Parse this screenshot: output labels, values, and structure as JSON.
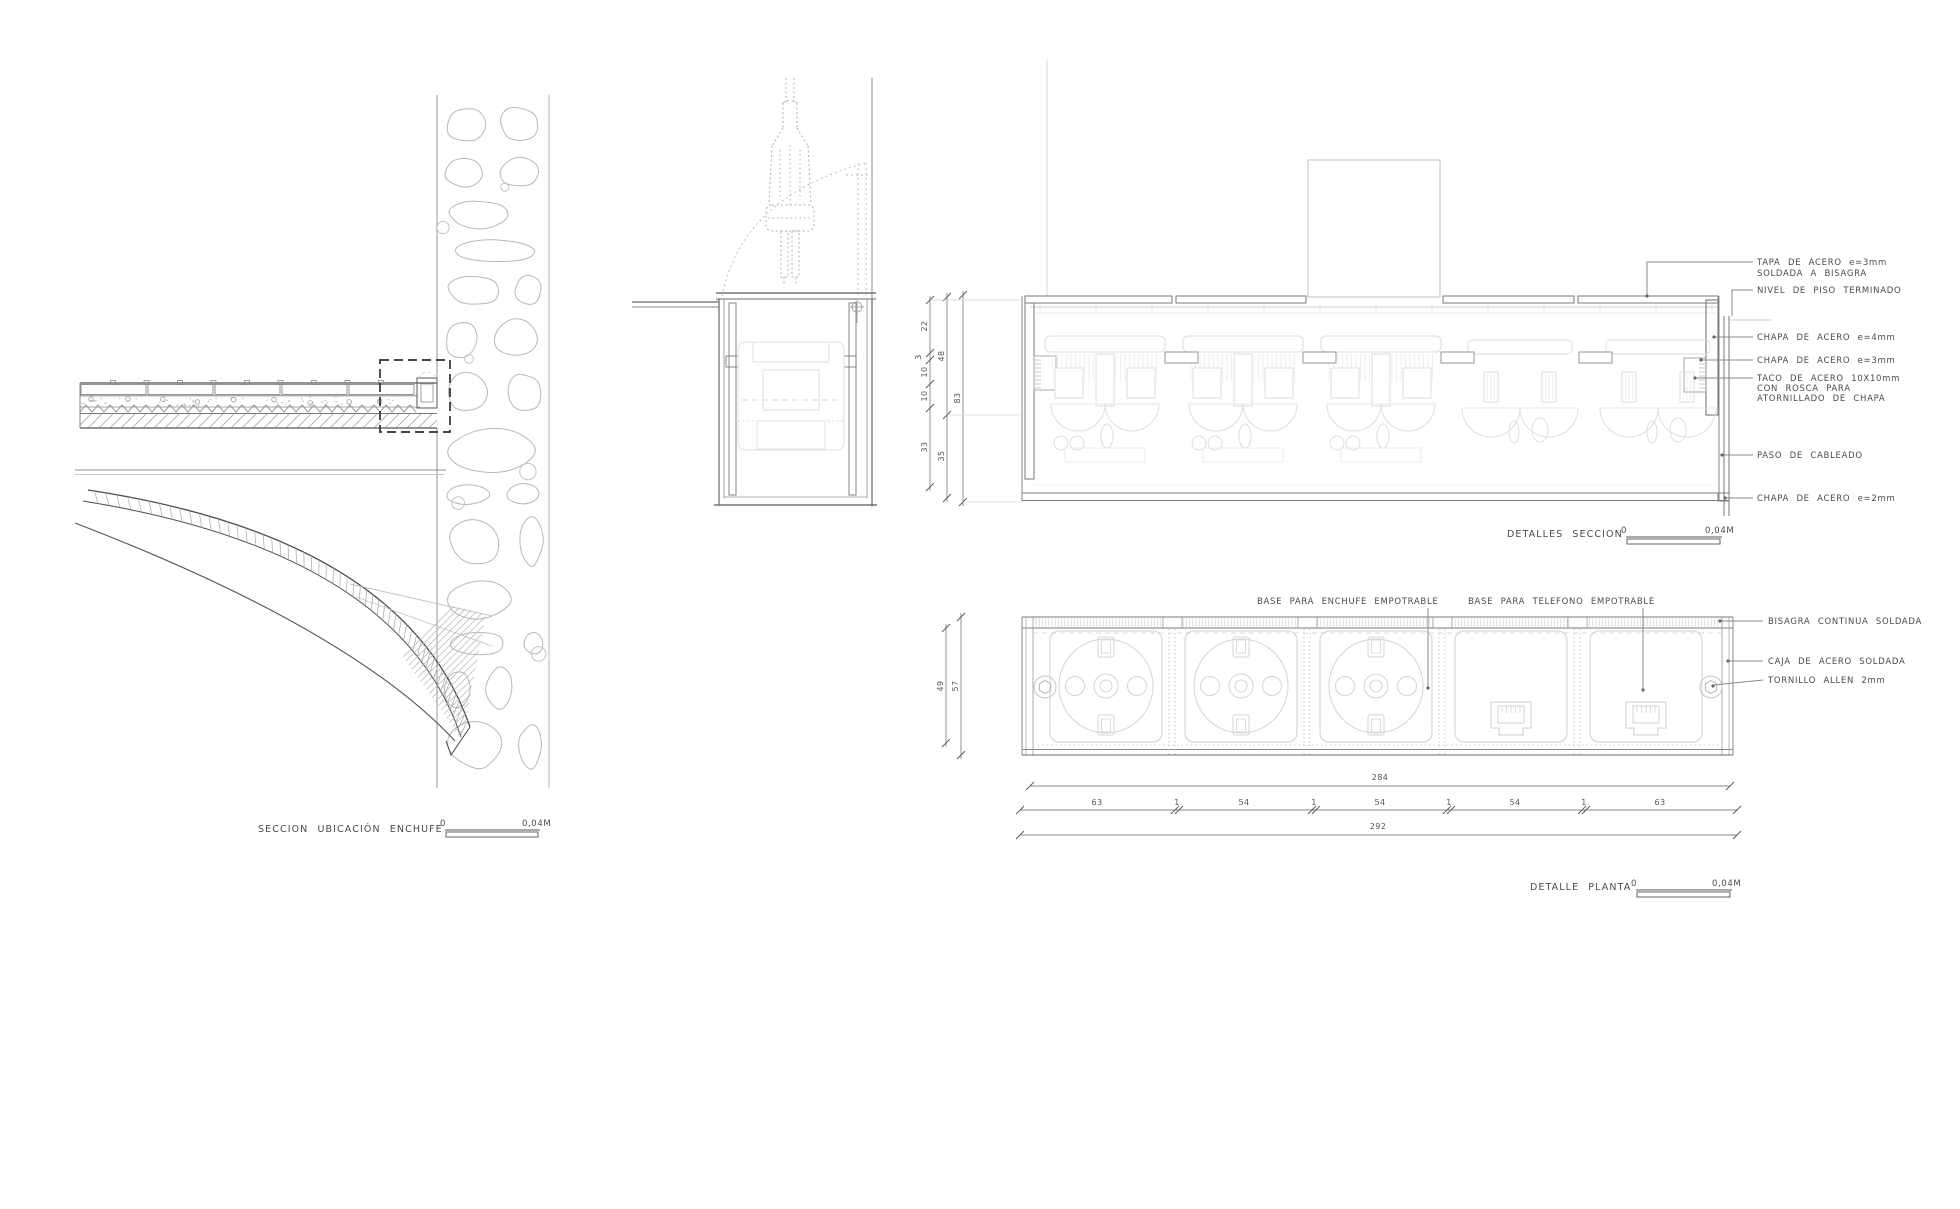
{
  "titles": {
    "left_view": "SECCION UBICACIÓN ENCHUFE",
    "section_detail": "DETALLES SECCION",
    "plan_detail": "DETALLE PLANTA"
  },
  "scale_bar": {
    "start": "0",
    "end": "0,04M"
  },
  "section_labels": {
    "tapa_line1": "TAPA DE ACERO e=3mm",
    "tapa_line2": "SOLDADA A BISAGRA",
    "nivel": "NIVEL DE PISO TERMINADO",
    "chapa4": "CHAPA DE ACERO e=4mm",
    "chapa3": "CHAPA DE ACERO e=3mm",
    "taco_line1": "TACO DE ACERO 10X10mm",
    "taco_line2": "CON ROSCA PARA",
    "taco_line3": "ATORNILLADO DE CHAPA",
    "paso": "PASO DE CABLEADO",
    "chapa2": "CHAPA DE ACERO e=2mm"
  },
  "plan_labels": {
    "enchufe": "BASE PARA ENCHUFE EMPOTRABLE",
    "telefono": "BASE PARA TELEFONO EMPOTRABLE",
    "bisagra": "BISAGRA CONTINUA SOLDADA",
    "caja": "CAJA DE ACERO SOLDADA",
    "tornillo": "TORNILLO ALLEN 2mm"
  },
  "dimensions": {
    "section_inner": [
      "22",
      "3",
      "10",
      "10",
      "33"
    ],
    "section_mid": [
      "48",
      "35"
    ],
    "section_total": "83",
    "plan_side_inner": "49",
    "plan_side_outer": "57",
    "plan_width_top": "284",
    "plan_segments": [
      "63",
      "1",
      "54",
      "1",
      "54",
      "1",
      "54",
      "1",
      "63"
    ],
    "plan_width_bottom": "292"
  }
}
